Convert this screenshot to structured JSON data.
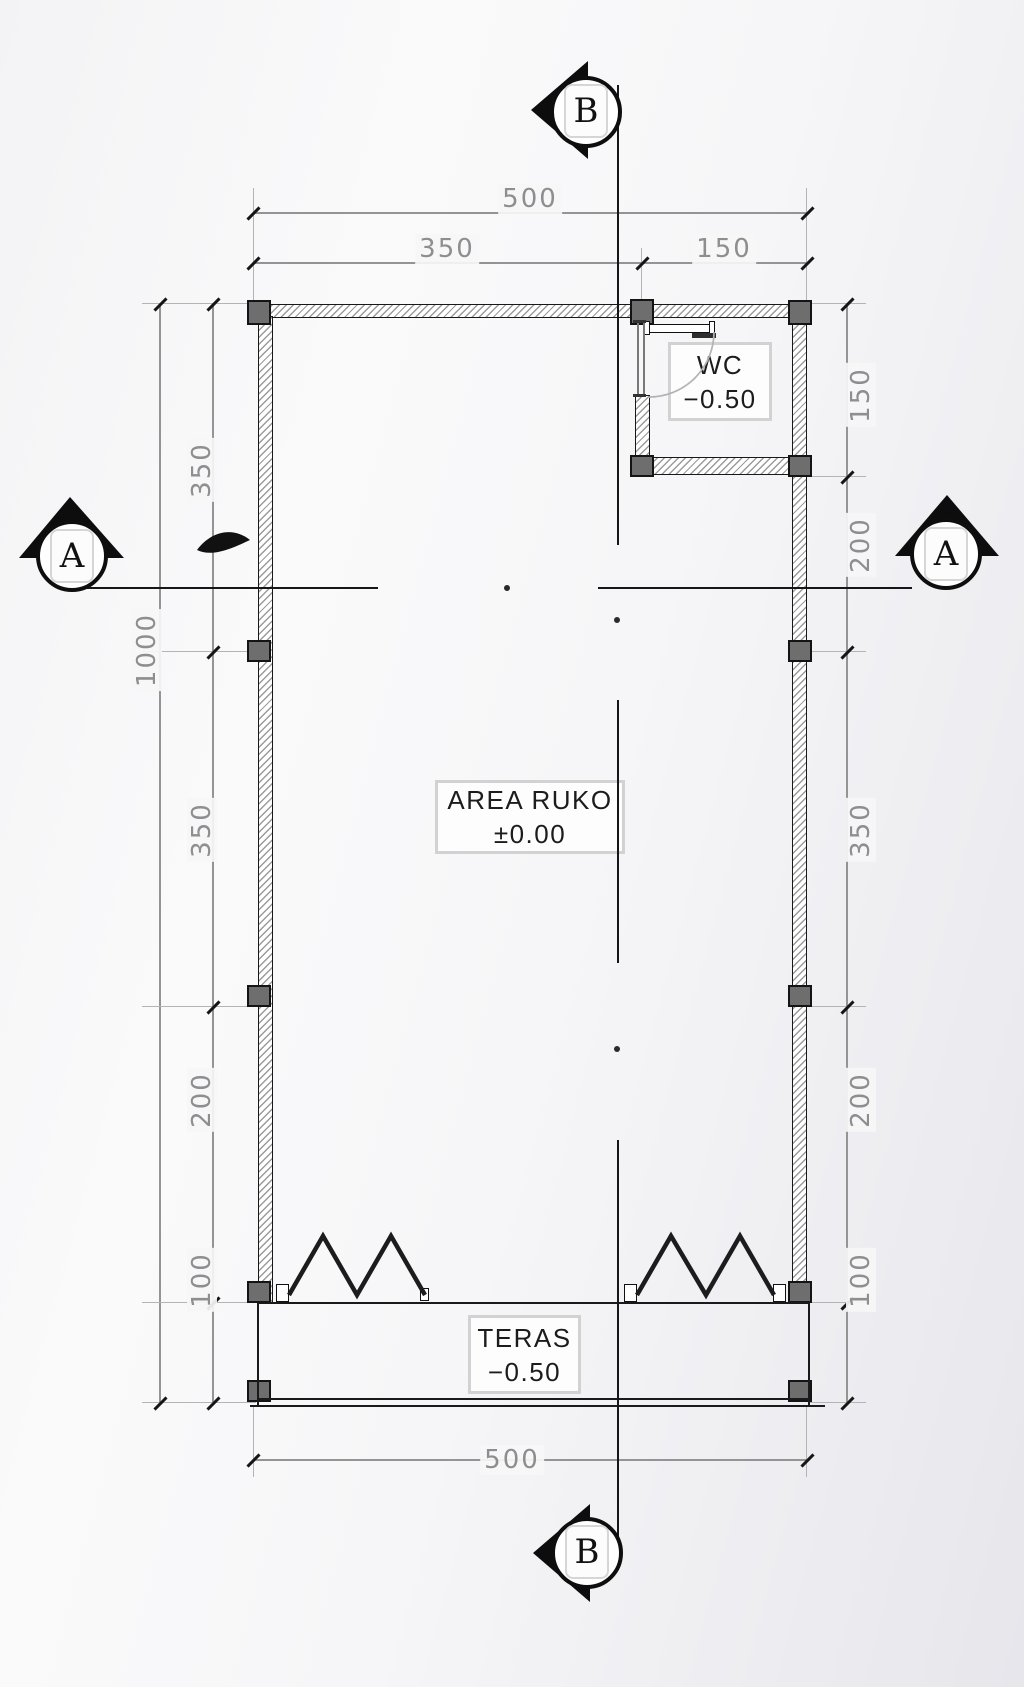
{
  "drawing": {
    "rooms": [
      {
        "id": "area-ruko",
        "name": "AREA RUKO",
        "level": "±0.00"
      },
      {
        "id": "wc",
        "name": "WC",
        "level": "−0.50"
      },
      {
        "id": "teras",
        "name": "TERAS",
        "level": "−0.50"
      }
    ],
    "section_markers": [
      {
        "id": "a-left",
        "letter": "A"
      },
      {
        "id": "a-right",
        "letter": "A"
      },
      {
        "id": "b-top",
        "letter": "B"
      },
      {
        "id": "b-bottom",
        "letter": "B"
      }
    ],
    "dimensions": {
      "top": {
        "overall": "500",
        "left": "350",
        "right": "150"
      },
      "bottom": {
        "overall": "500"
      },
      "left": {
        "overall": "1000",
        "segments": [
          "350",
          "350",
          "200",
          "100"
        ]
      },
      "right": {
        "segments": [
          "150",
          "200",
          "350",
          "200",
          "100"
        ]
      }
    },
    "colors": {
      "wall_hatch": "#9b9b9b",
      "column_fill": "#6e6e6e",
      "line_dark": "#1a1a1a",
      "dimension_gray": "#8e8e90",
      "label_border": "#d2d2d2"
    }
  }
}
